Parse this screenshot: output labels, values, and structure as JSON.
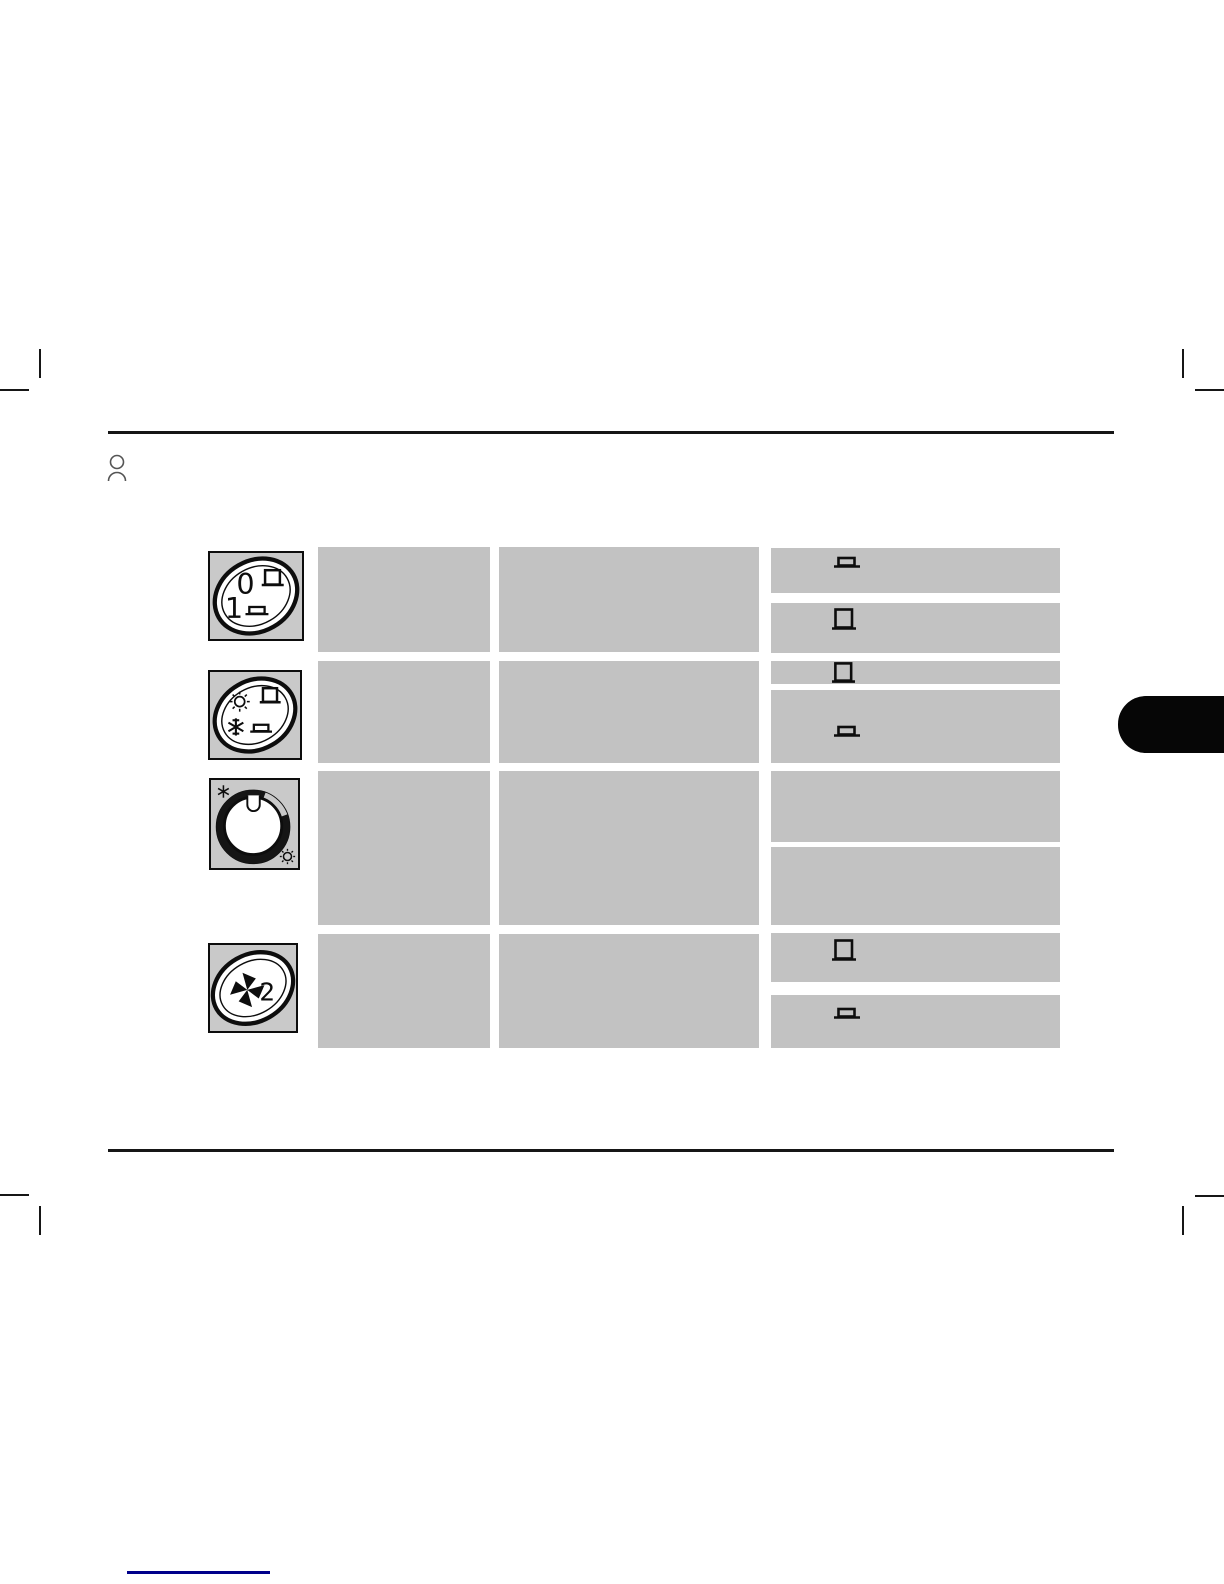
{
  "page": {
    "background_color": "#ffffff",
    "rule_color": "#161616",
    "cell_color": "#c2c2c2",
    "icon_box_color": "#c9c9c9",
    "side_tab_color": "#060606",
    "footer_line_color": "#00008b"
  },
  "header": {
    "person_icon": "person-outline-icon"
  },
  "controls_table": {
    "rows": [
      {
        "control": "two-position-switch",
        "control_icon": "switch-0-1-oval-icon",
        "labels": {
          "off": "0",
          "on": "1"
        },
        "detail_cells": [
          {
            "icon": "seat-flat-icon"
          },
          {
            "icon": "seat-raised-icon"
          }
        ]
      },
      {
        "control": "sun-snowflake-switch",
        "control_icon": "switch-sun-snowflake-oval-icon",
        "detail_cells": [
          {
            "icon": "seat-raised-icon"
          },
          {
            "icon": "seat-flat-icon"
          }
        ]
      },
      {
        "control": "temperature-knob",
        "control_icon": "rotary-temperature-knob-icon",
        "detail_cells": [
          {
            "icon": null
          },
          {
            "icon": null
          }
        ]
      },
      {
        "control": "fan-speed-switch",
        "control_icon": "fan-speed-2-oval-icon",
        "labels": {
          "speed": "2"
        },
        "detail_cells": [
          {
            "icon": "seat-raised-icon"
          },
          {
            "icon": "seat-flat-icon"
          }
        ]
      }
    ]
  }
}
